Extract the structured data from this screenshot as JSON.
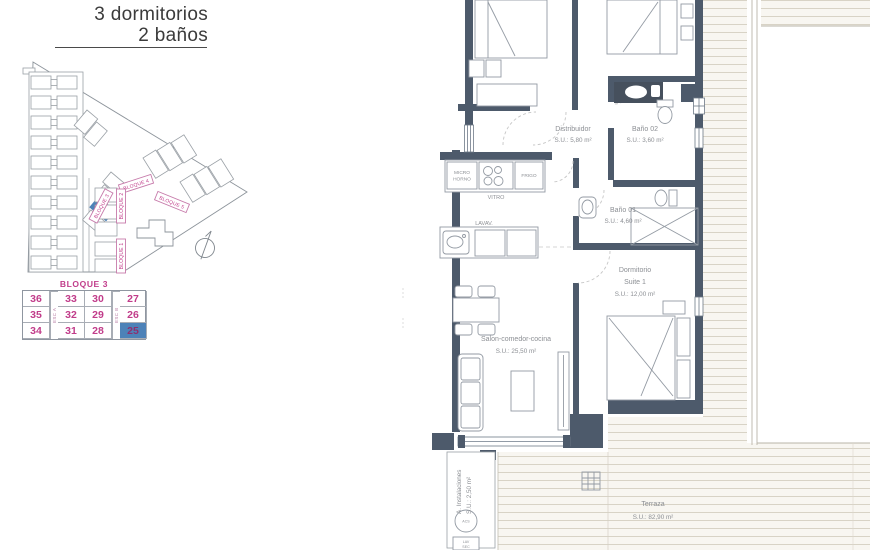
{
  "header": {
    "line1": "3 dormitorios",
    "line2": "2 baños"
  },
  "site_plan": {
    "bloque1": "BLOQUE 1",
    "bloque2": "BLOQUE 2",
    "bloque3": "BLOQUE 3",
    "bloque4": "BLOQUE 4",
    "bloque5": "BLOQUE 5"
  },
  "unit_table": {
    "title": "BLOQUE 3",
    "stair_a": "ESC A",
    "stair_b": "ESC B",
    "rows": [
      [
        "36",
        "33",
        "30",
        "27"
      ],
      [
        "35",
        "32",
        "29",
        "26"
      ],
      [
        "34",
        "31",
        "28",
        "25"
      ]
    ],
    "highlighted_unit": "25"
  },
  "floor_plan": {
    "distribuidor_name": "Distribuidor",
    "distribuidor_area": "S.U.: 5,80 m²",
    "bano02_name": "Baño 02",
    "bano02_area": "S.U.: 3,60 m²",
    "bano01_name": "Baño 01",
    "bano01_area": "S.U.: 4,60 m²",
    "suite_name1": "Dormitorio",
    "suite_name2": "Suite 1",
    "suite_area": "S.U.: 12,00 m²",
    "salon_name": "Salon-comedor-cocina",
    "salon_area": "S.U.: 25,50 m²",
    "terraza_name": "Terraza",
    "terraza_area": "S.U.: 82,90 m²",
    "instalaciones_name": "A. Instalaciones",
    "instalaciones_area": "S.U.: 2,50 m²",
    "kitchen_micro1": "MICRO",
    "kitchen_micro2": "HORNO",
    "kitchen_vitro": "VITRO",
    "kitchen_frigo": "FRIGO",
    "kitchen_lavav": "LAVAV.",
    "util_circle": "ACS",
    "util_box1": "LAV",
    "util_box2": "SEC"
  },
  "colors": {
    "wall": "#4d5a6b",
    "accent_pink": "#c13c8a",
    "accent_blue": "#4d82b8"
  }
}
